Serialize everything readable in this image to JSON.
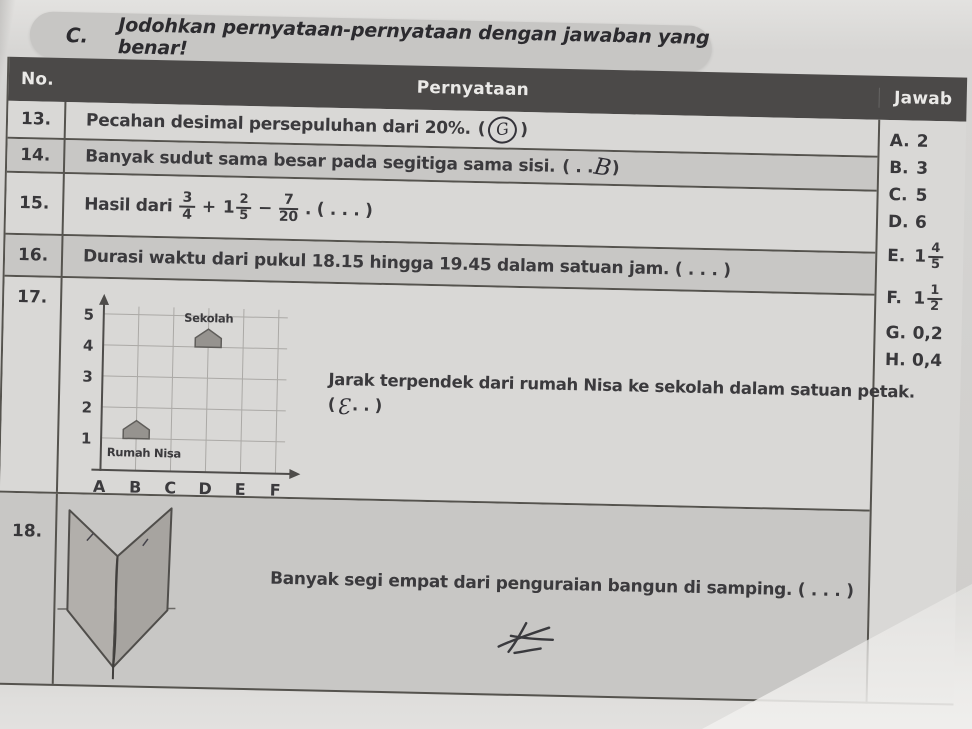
{
  "page": {
    "section_label": "C.",
    "title": "Jodohkan pernyataan-pernyataan dengan jawaban yang benar!"
  },
  "table": {
    "headers": {
      "no": "No.",
      "statement": "Pernyataan",
      "answer": "Jawab"
    },
    "rows": [
      {
        "no": "13.",
        "text": "Pecahan desimal persepuluhan dari 20%.",
        "open": "(",
        "handwritten_answer": "G",
        "close": " )"
      },
      {
        "no": "14.",
        "text": "Banyak sudut sama besar pada segitiga sama sisi.",
        "open": "( . .",
        "handwritten_answer": "B",
        "close": ")"
      },
      {
        "no": "15.",
        "prefix": "Hasil dari",
        "frac1": {
          "num": "3",
          "den": "4"
        },
        "op1": "+",
        "mixed_whole": "1",
        "frac2": {
          "num": "2",
          "den": "5"
        },
        "op2": "−",
        "frac3": {
          "num": "7",
          "den": "20"
        },
        "suffix": ". ( . . . )"
      },
      {
        "no": "16.",
        "text": "Durasi waktu dari pukul 18.15 hingga 19.45 dalam satuan jam. ( . . . )"
      },
      {
        "no": "17.",
        "text": "Jarak terpendek dari rumah Nisa ke sekolah dalam satuan petak.",
        "open": "(",
        "handwritten_answer": "Ɛ",
        "close": ". . )"
      },
      {
        "no": "18.",
        "text": "Banyak segi empat dari penguraian bangun di samping. ( . . . )"
      }
    ]
  },
  "answers": {
    "items": [
      {
        "label": "A.",
        "value": "2"
      },
      {
        "label": "B.",
        "value": "3"
      },
      {
        "label": "C.",
        "value": "5"
      },
      {
        "label": "D.",
        "value": "6"
      },
      {
        "label": "E.",
        "whole": "1",
        "num": "4",
        "den": "5"
      },
      {
        "label": "F.",
        "whole": "1",
        "num": "1",
        "den": "2"
      },
      {
        "label": "G.",
        "value": "0,2"
      },
      {
        "label": "H.",
        "value": "0,4"
      }
    ]
  },
  "chart_data": {
    "type": "scatter",
    "title": "",
    "x_labels": [
      "A",
      "B",
      "C",
      "D",
      "E",
      "F"
    ],
    "y_labels": [
      "5",
      "4",
      "3",
      "2",
      "1"
    ],
    "grid": true,
    "points": [
      {
        "label": "Sekolah",
        "x": "D",
        "y": 4
      },
      {
        "label": "Rumah Nisa",
        "x": "B",
        "y": 1
      }
    ]
  }
}
